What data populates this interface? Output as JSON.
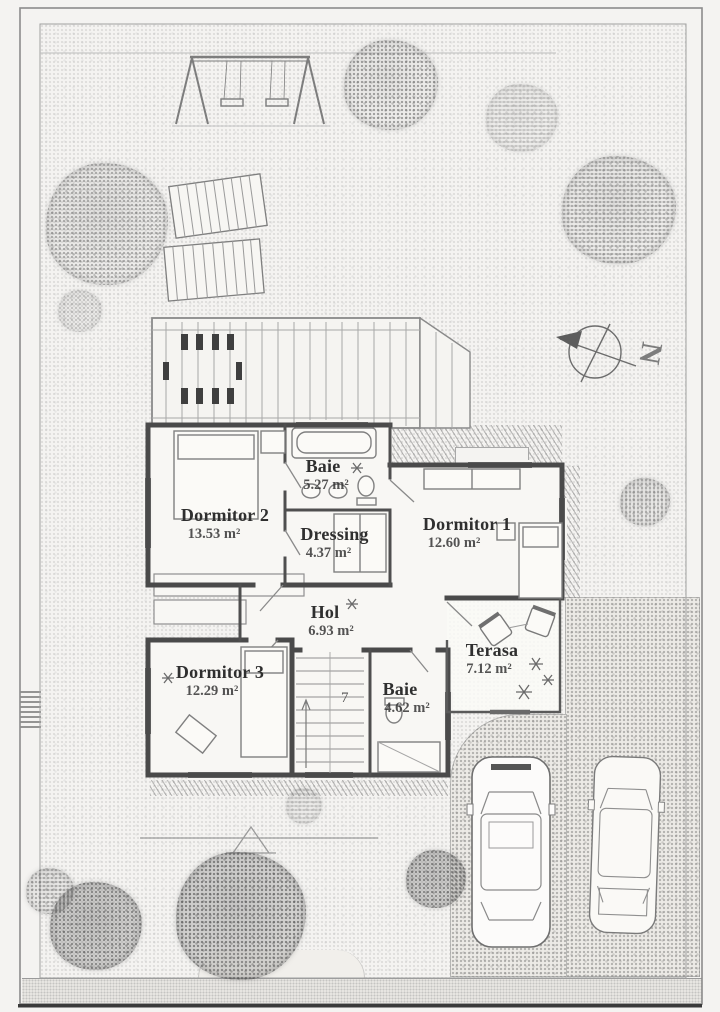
{
  "plan": {
    "palette": {
      "paper": "#f4f3f1",
      "ink": "#4a4a4a"
    },
    "compass": {
      "north_label": "N"
    },
    "stairs": {
      "step_count": "7"
    },
    "rooms": [
      {
        "name": "Dormitor 2",
        "area": "13.53 m²"
      },
      {
        "name": "Baie",
        "area": "5.27 m²"
      },
      {
        "name": "Dressing",
        "area": "4.37 m²"
      },
      {
        "name": "Dormitor 1",
        "area": "12.60 m²"
      },
      {
        "name": "Hol",
        "area": "6.93 m²"
      },
      {
        "name": "Terasa",
        "area": "7.12 m²"
      },
      {
        "name": "Dormitor 3",
        "area": "12.29 m²"
      },
      {
        "name": "Baie",
        "area": "4.62 m²"
      }
    ]
  }
}
